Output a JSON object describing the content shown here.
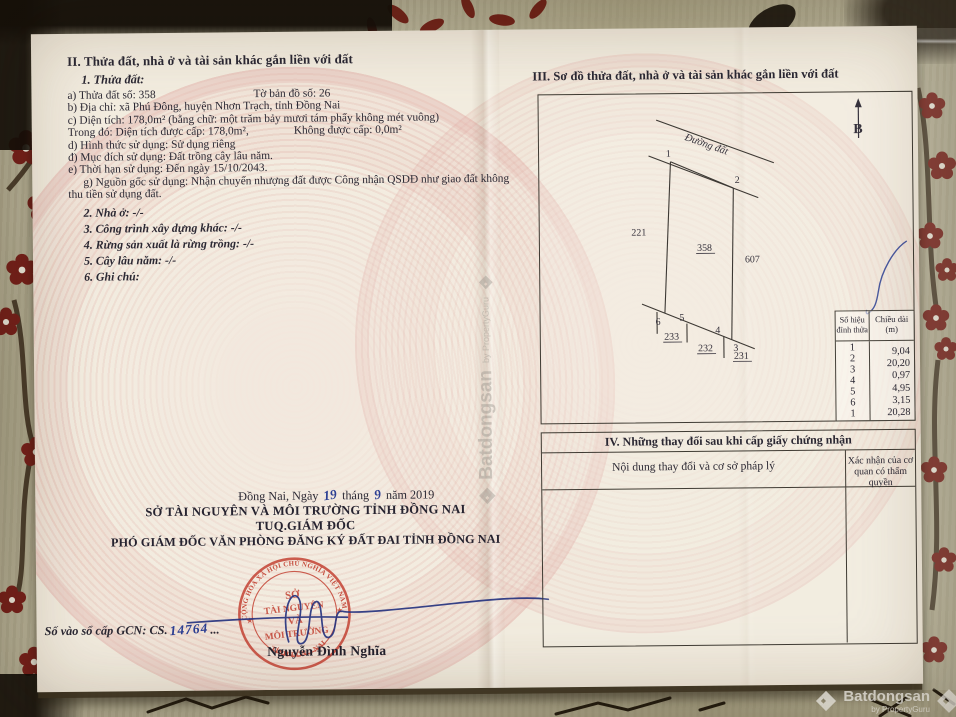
{
  "colors": {
    "stamp_red": "#c23f30",
    "ink_blue": "#2c3f93",
    "paper": "#f2ecdf",
    "guilloche_pink": "#dfa69e",
    "fabric_olive": "#b4ae93",
    "flower_red": "#76201a"
  },
  "watermark": {
    "brand": "Batdongsan",
    "byline": "by PropertyGuru"
  },
  "left_page": {
    "heading": "II. Thửa đất, nhà ở và tài sản khác gắn liền với đất",
    "parcel_title": "1. Thửa đất:",
    "line_a": "a) Thửa đất số:  358",
    "line_a2": "Tờ bản đồ số:   26",
    "line_b": "b) Địa chỉ: xã Phú Đông, huyện Nhơn Trạch, tỉnh Đồng Nai",
    "line_c": "c) Diện tích: 178,0m² (bằng chữ: một trăm bảy mươi tám phẩy không mét vuông)",
    "line_c2a": "Trong đó: Diện tích được cấp: 178,0m²,",
    "line_c2b": "Không được cấp: 0,0m²",
    "line_d": "d) Hình thức sử dụng: Sử dụng riêng",
    "line_dd": "đ) Mục đích sử dụng: Đất trồng cây lâu năm.",
    "line_e": "e) Thời hạn sử dụng: Đến ngày 15/10/2043.",
    "line_g": "g) Nguồn gốc sử dụng: Nhận chuyển nhượng đất được Công nhận QSDĐ như giao đất không thu tiền sử dụng đất.",
    "item2": "2. Nhà ở: -/-",
    "item3": "3. Công trình xây dựng khác:  -/-",
    "item4": "4. Rừng sản xuất là rừng trồng: -/-",
    "item5": "5. Cây lâu năm: -/-",
    "item6": "6. Ghi chú:",
    "signature": {
      "place": "Đồng Nai, Ngày",
      "day": "19",
      "thang": "tháng",
      "month": "9",
      "nam": "năm 2019",
      "org1": "SỞ TÀI NGUYÊN VÀ MÔI TRƯỜNG TỈNH ĐỒNG NAI",
      "org2": "TUQ.GIÁM ĐỐC",
      "org3": "PHÓ GIÁM ĐỐC VĂN PHÒNG ĐĂNG KÝ ĐẤT ĐAI TỈNH ĐỒNG NAI",
      "signer": "Nguyễn Đình Nghĩa",
      "gcn_label": "Số vào sổ cấp GCN: CS.",
      "gcn_number": "14764",
      "gcn_trail": "..."
    },
    "stamp": {
      "arc_top": "CỘNG HÒA XÃ HỘI CHỦ NGHĨA VIỆT NAM",
      "arc_bottom": "TỈNH ĐỒNG NAI",
      "l1": "SỞ",
      "l2": "TÀI NGUYÊN",
      "l3": "VÀ",
      "l4": "MÔI TRƯỜNG",
      "star": "★"
    }
  },
  "right_page": {
    "heading": "III. Sơ đồ thửa đất, nhà ở và tài sản khác gắn liền với đất",
    "diagram": {
      "north": "B",
      "road": "Đường đất",
      "v1": "1",
      "v2": "2",
      "v3": "3",
      "v4": "4",
      "v5": "5",
      "v6": "6",
      "p221": "221",
      "p358": "358",
      "p607": "607",
      "p233": "233",
      "p232": "232",
      "p231": "231"
    },
    "vertex_table": {
      "h1a": "Số hiệu",
      "h1b": "đỉnh thửa",
      "h2a": "Chiều dài",
      "h2b": "(m)",
      "v": [
        "1",
        "2",
        "3",
        "4",
        "5",
        "6",
        "1"
      ],
      "len": [
        "9,04",
        "20,20",
        "0,97",
        "4,95",
        "3,15",
        "20,28"
      ]
    },
    "section4": {
      "title": "IV. Những thay đổi sau khi cấp giấy chứng nhận",
      "col1": "Nội dung thay đổi và cơ sở pháp lý",
      "col2": "Xác nhận của cơ quan có thẩm quyền"
    }
  }
}
